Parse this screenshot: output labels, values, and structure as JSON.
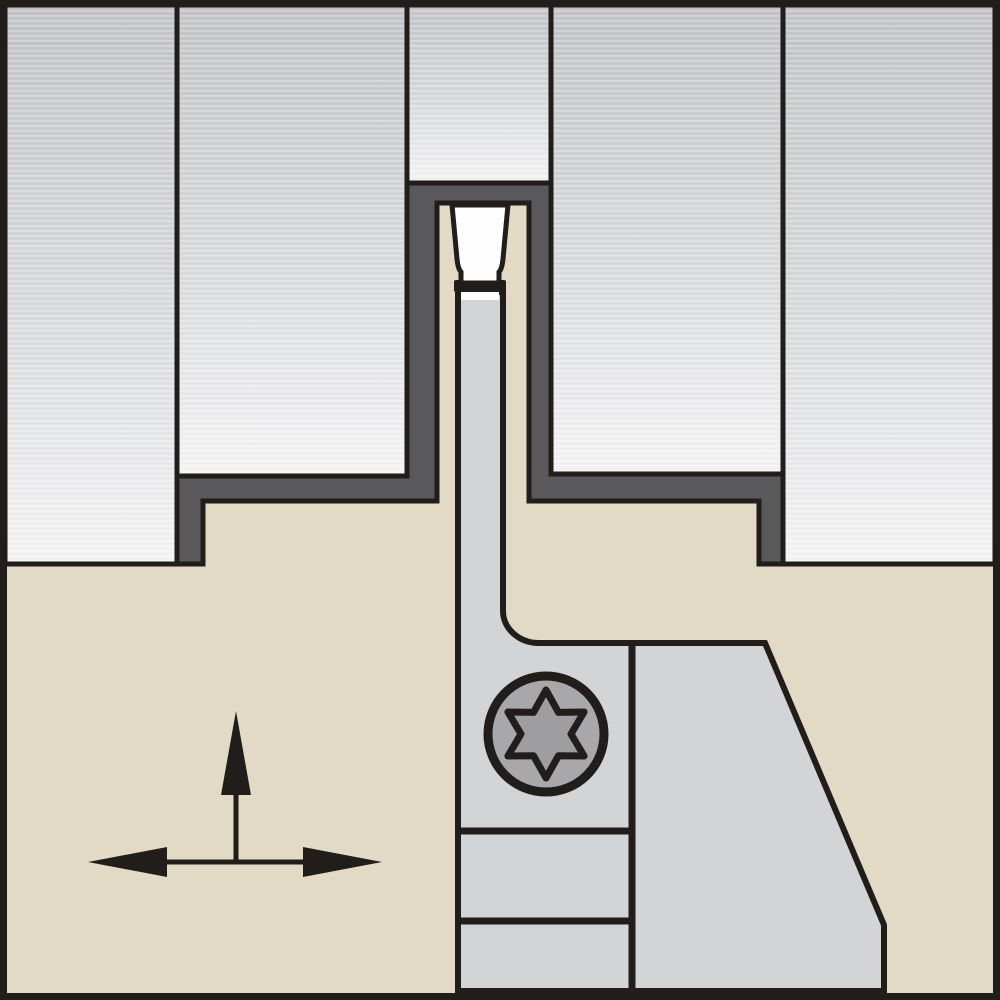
{
  "diagram": {
    "type": "technical-illustration",
    "subject": "Front view of a shallow grooving operation: white cutting insert on a support blade with Torx clamp screw, cutting a groove into a gray workpiece; feed-direction arrows at lower left",
    "text_content": "none"
  },
  "palette": {
    "background_tan": "#e3dac6",
    "outline_black": "#211d1a",
    "workpiece_top": "#c3c4c7",
    "workpiece_mid": "#d9dadc",
    "workpiece_bottom": "#f4f4f5",
    "machined_surface_charcoal": "#59595b",
    "blade_gray": "#d3d4d6",
    "insert_white": "#fdfdfd",
    "screw_gray": "#a8a8aa",
    "torx_recess_gray": "#9e9ea1"
  },
  "parts": {
    "tool_body": {
      "label": "Tool holder body (tan)"
    },
    "workpiece": {
      "label": "Workpiece (gray, sectioned)"
    },
    "workpiece_left_outer": {
      "label": "Workpiece segment - outer left"
    },
    "workpiece_left_inner": {
      "label": "Workpiece segment - inner left"
    },
    "workpiece_center_stub": {
      "label": "Workpiece stub above groove"
    },
    "workpiece_right_inner": {
      "label": "Workpiece segment - inner right"
    },
    "workpiece_right_outer": {
      "label": "Workpiece segment - outer right"
    },
    "machined_groove": {
      "label": "Machined groove surface (dark)"
    },
    "insert": {
      "label": "Grooving insert (white)"
    },
    "insert_edge": {
      "label": "Insert cutting edge"
    },
    "blade": {
      "label": "Insert support blade"
    },
    "clamp_screw": {
      "label": "Clamp screw head"
    },
    "torx_icon": {
      "label": "Torx T-star recess, 6 lobes"
    },
    "feed_arrows": {
      "label": "Feed direction arrows: up, left, right"
    }
  },
  "icons": [
    {
      "name": "torx-screw-icon",
      "lobes": 6
    },
    {
      "name": "feed-arrows-icon",
      "directions": [
        "up",
        "left",
        "right"
      ]
    }
  ]
}
